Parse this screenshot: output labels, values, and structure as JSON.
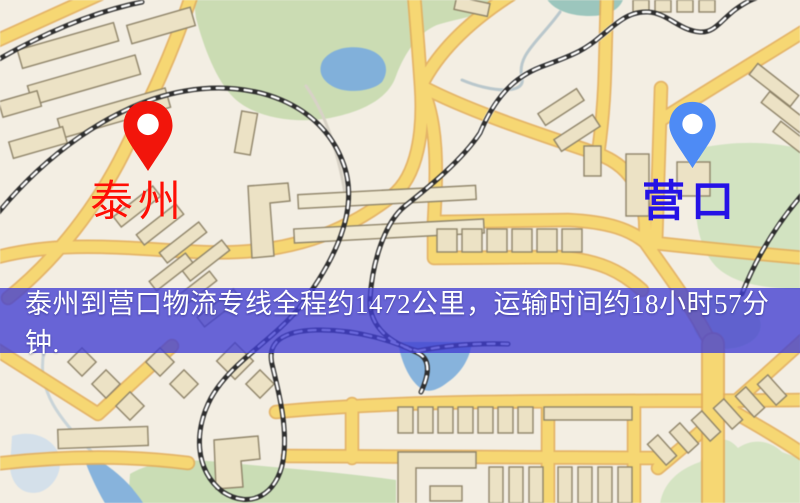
{
  "map": {
    "origin_label": "泰州",
    "destination_label": "营口",
    "origin_marker_color": "#f2150b",
    "destination_marker_color": "#4e8bf5",
    "origin_label_color": "#ff0f05",
    "destination_label_color": "#2512e6"
  },
  "banner": {
    "text": "泰州到营口物流专线全程约1472公里，运输时间约18小时57分钟.",
    "distance_km": "1472",
    "duration_hours": "18",
    "duration_minutes": "57",
    "background_color": "#403ed2",
    "text_color": "#ffffff"
  },
  "palette": {
    "map_background": "#f3eee3",
    "road_primary": "#f7d76f",
    "road_border": "#e4ad55",
    "minor_road": "#ffffff",
    "park_green": "#cbdcb2",
    "water_blue": "#7fb0dc",
    "railway_dark": "#2e2e2e",
    "building_fill": "#ece2c4",
    "building_outline": "#8f8468"
  }
}
